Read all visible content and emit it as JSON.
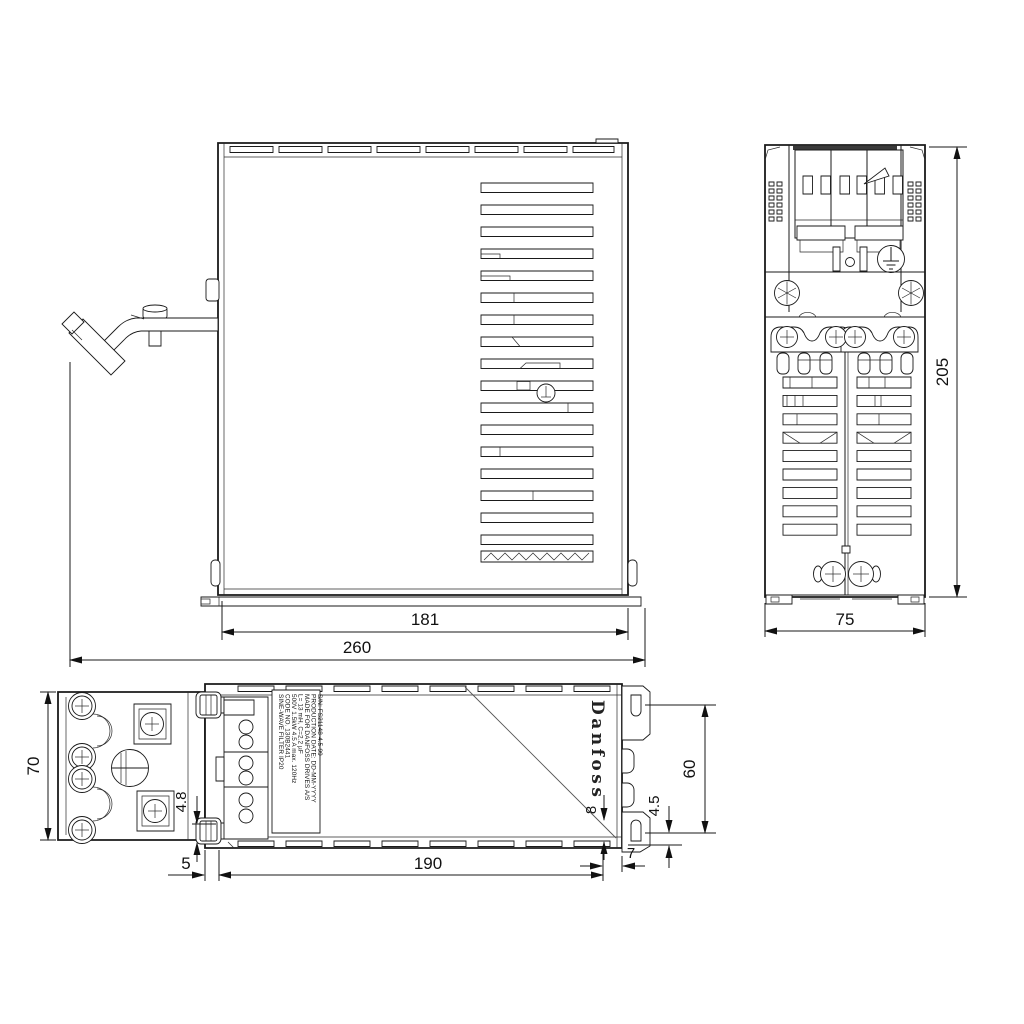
{
  "logo": {
    "text": "Danfoss"
  },
  "label": {
    "lines": [
      "SINE-WAVE FILTER   IP20",
      "CODE NO. 130B2441",
      "500V 1.5kW 4.5 A  max. 120Hz",
      "L= 13 mH, C=2.2 µF",
      "MADE FOR DANFOSS DRIVES A/S",
      "PRODUCTION DATE: DD-MM-YYYY",
      "S/N: FS21148-4.5-99"
    ]
  },
  "dimensions": {
    "side_view": {
      "inner_width": "181",
      "overall_width": "260"
    },
    "front_view": {
      "height": "205",
      "width": "75"
    },
    "bottom_view": {
      "clamp_width": "70",
      "body_length": "190",
      "offset_left": "5",
      "offset_right": "7",
      "slot_offset": "4.5",
      "hole": "4.8",
      "corner": "8",
      "slot_spacing": "60"
    }
  }
}
